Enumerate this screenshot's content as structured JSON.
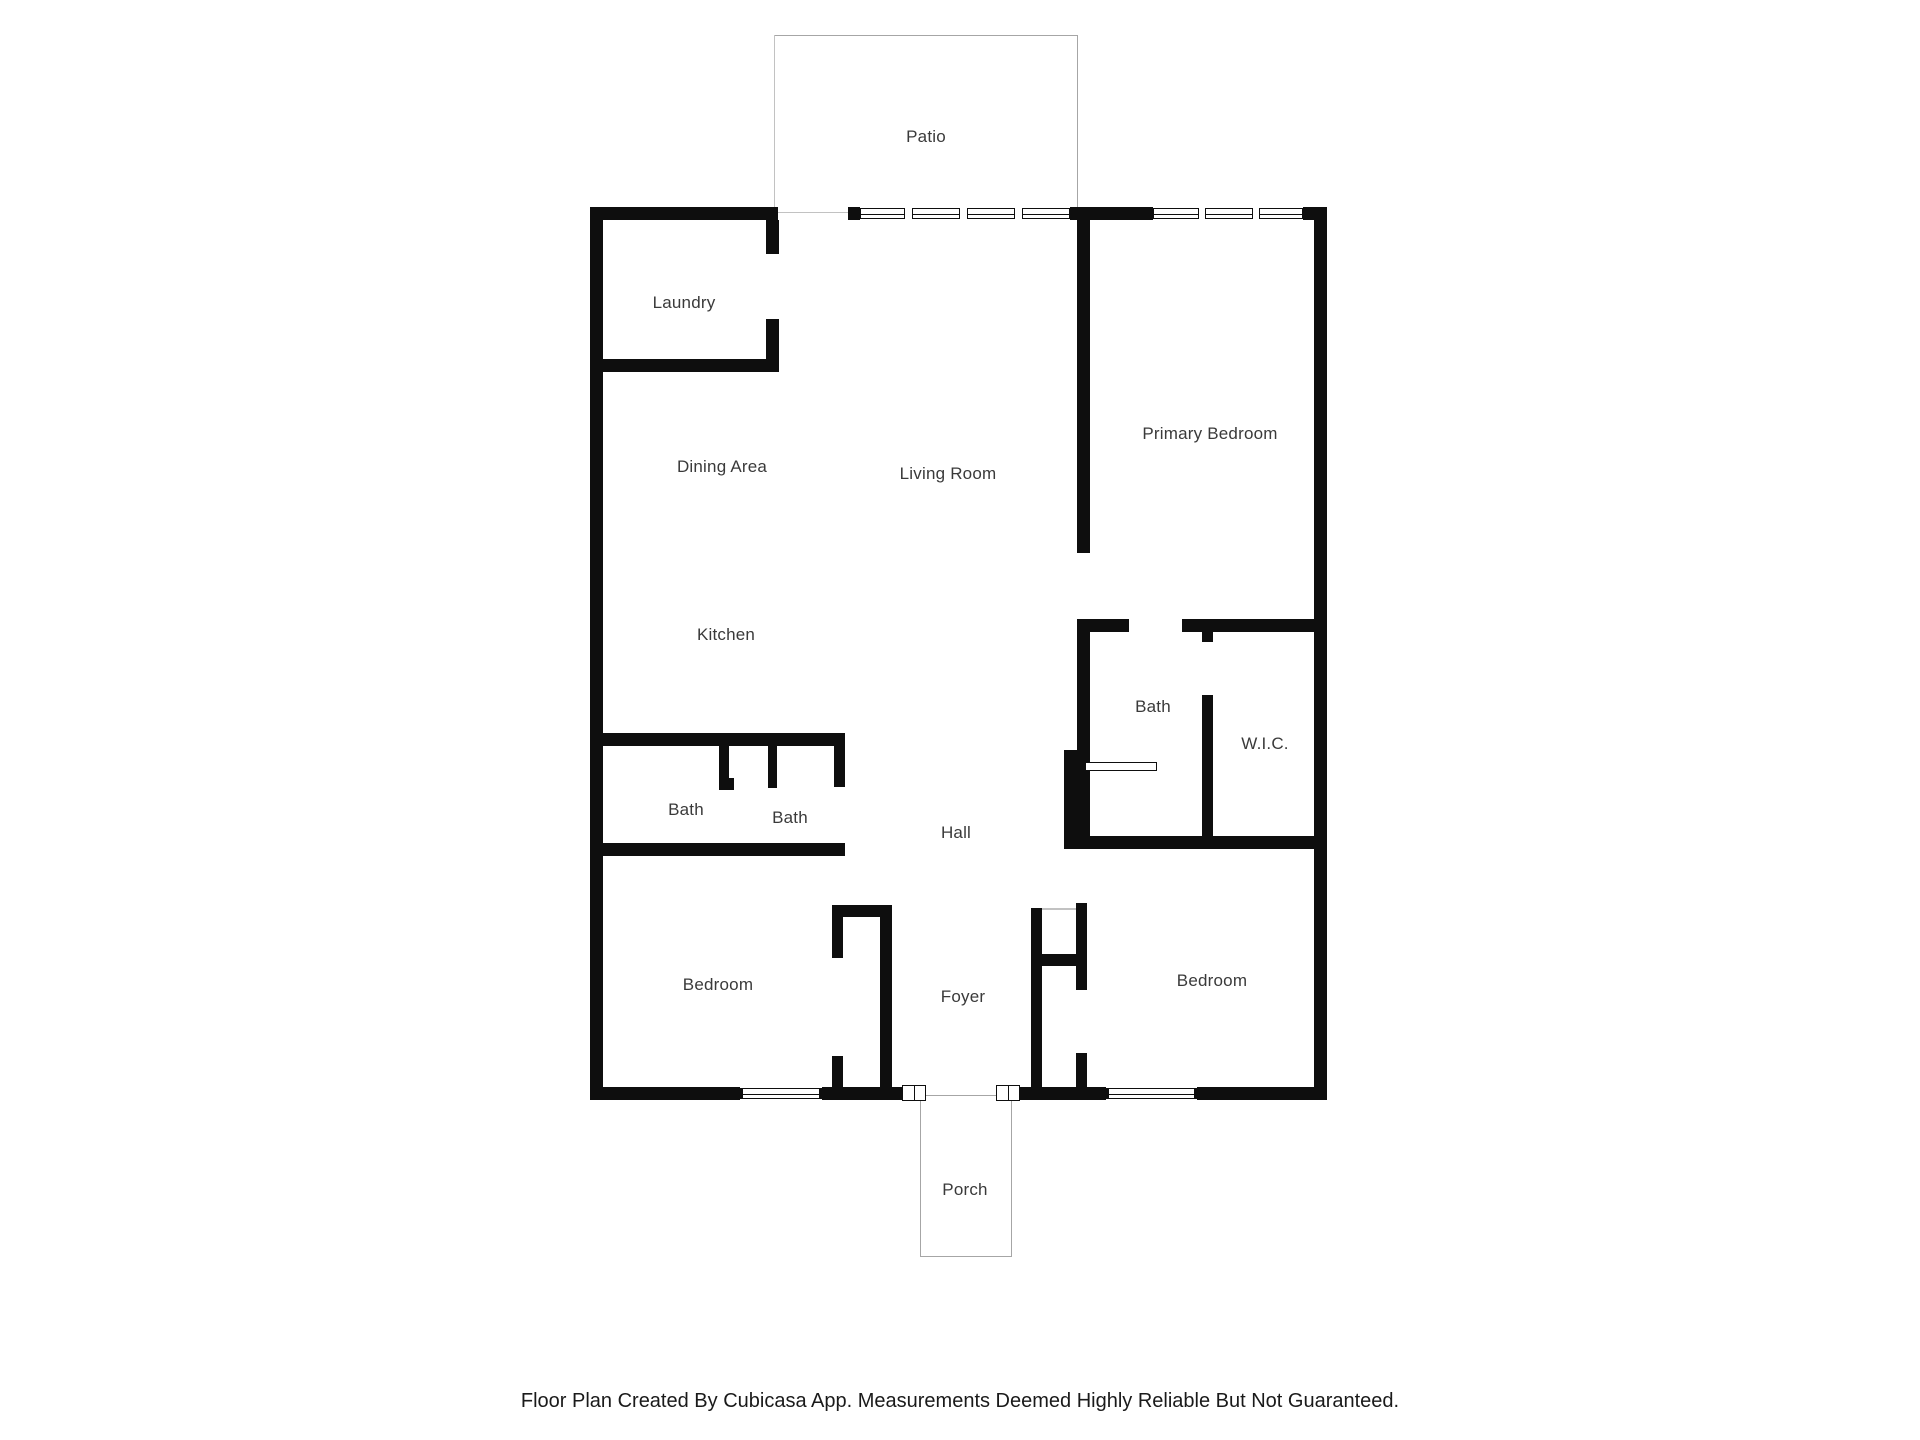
{
  "floor_plan": {
    "rooms": {
      "patio": "Patio",
      "laundry": "Laundry",
      "dining_area": "Dining Area",
      "living_room": "Living Room",
      "primary_bedroom": "Primary Bedroom",
      "kitchen": "Kitchen",
      "bath_hall_left": "Bath",
      "bath_hall_right": "Bath",
      "bath_primary": "Bath",
      "walk_in_closet": "W.I.C.",
      "hall": "Hall",
      "bedroom_left": "Bedroom",
      "bedroom_right": "Bedroom",
      "foyer": "Foyer",
      "porch": "Porch"
    },
    "footer_note": "Floor Plan Created By Cubicasa App. Measurements Deemed Highly Reliable But Not Guaranteed.",
    "colors": {
      "wall": "#0e0e0e",
      "outline": "#a6a6a6",
      "label": "#3a3a3a"
    }
  }
}
